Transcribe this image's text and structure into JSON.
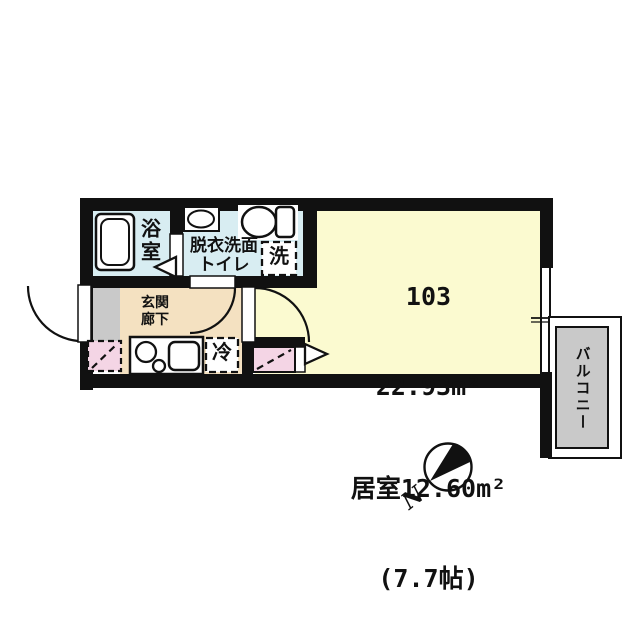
{
  "floorplan": {
    "unit": {
      "number": "103",
      "total_area": "22.93m²",
      "room_area": "居室12.60m²",
      "room_size": "(7.7帖)"
    },
    "labels": {
      "bathroom": "浴室",
      "washroom_line1": "脱衣洗面",
      "washroom_line2": "トイレ",
      "washer": "洗",
      "hallway_line1": "玄関",
      "hallway_line2": "廊下",
      "fridge": "冷",
      "balcony": "バルコニー",
      "north": "N"
    },
    "colors": {
      "wall": "#111111",
      "wet_area": "#d8edf2",
      "hallway": "#f4e1c1",
      "living_room": "#fbfad0",
      "balcony_floor": "#c9c9c9",
      "entry_floor": "#c9c9c9",
      "storage_pink": "#f4d5e5"
    }
  }
}
